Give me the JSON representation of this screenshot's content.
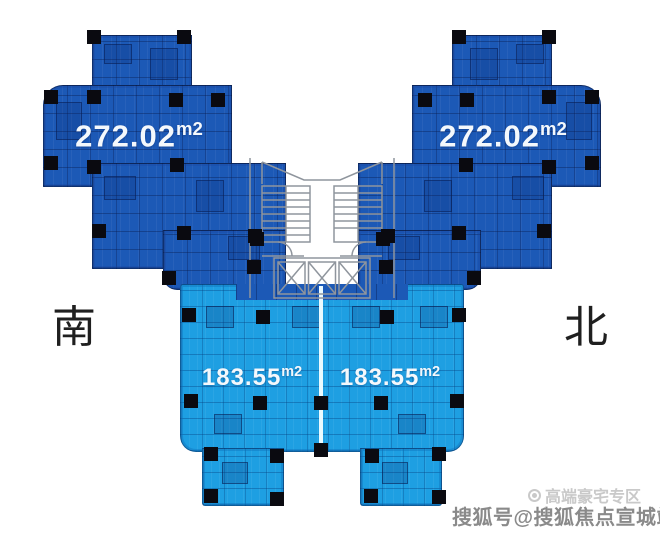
{
  "colors": {
    "dark_unit": "#1c59b6",
    "light_unit": "#1e9fe2",
    "column": "#0a0a10",
    "divider": "#eafaff",
    "label_text": "#f4f8fc",
    "compass": "#1f1f1f",
    "core_line": "#8f959d",
    "watermark_light": "#c9c9c9",
    "watermark_dark": "#8a8a8a"
  },
  "units": {
    "upper_left": {
      "area": "272.02",
      "unit": "m2"
    },
    "upper_right": {
      "area": "272.02",
      "unit": "m2"
    },
    "lower_left": {
      "area": "183.55",
      "unit": "m2"
    },
    "lower_right": {
      "area": "183.55",
      "unit": "m2"
    }
  },
  "compass": {
    "south_label": "南",
    "north_label": "北"
  },
  "watermark": {
    "brand_line": "高端豪宅专区",
    "account_line": "搜狐号@搜狐焦点宣城站"
  },
  "floorplan": {
    "columns": [
      [
        87,
        30
      ],
      [
        177,
        30
      ],
      [
        44,
        90
      ],
      [
        87,
        90
      ],
      [
        169,
        93
      ],
      [
        211,
        93
      ],
      [
        44,
        156
      ],
      [
        87,
        160
      ],
      [
        170,
        158
      ],
      [
        92,
        224
      ],
      [
        177,
        226
      ],
      [
        248,
        229
      ],
      [
        162,
        271
      ],
      [
        542,
        30
      ],
      [
        452,
        30
      ],
      [
        585,
        90
      ],
      [
        542,
        90
      ],
      [
        460,
        93
      ],
      [
        418,
        93
      ],
      [
        585,
        156
      ],
      [
        542,
        160
      ],
      [
        459,
        158
      ],
      [
        537,
        224
      ],
      [
        452,
        226
      ],
      [
        381,
        229
      ],
      [
        467,
        271
      ],
      [
        250,
        232
      ],
      [
        376,
        232
      ],
      [
        247,
        260
      ],
      [
        379,
        260
      ],
      [
        182,
        308
      ],
      [
        256,
        310
      ],
      [
        380,
        310
      ],
      [
        452,
        308
      ],
      [
        184,
        394
      ],
      [
        253,
        396
      ],
      [
        314,
        396
      ],
      [
        374,
        396
      ],
      [
        450,
        394
      ],
      [
        314,
        443
      ],
      [
        204,
        447
      ],
      [
        270,
        449
      ],
      [
        365,
        449
      ],
      [
        432,
        447
      ],
      [
        204,
        489
      ],
      [
        270,
        492
      ],
      [
        364,
        489
      ],
      [
        432,
        490
      ]
    ]
  }
}
